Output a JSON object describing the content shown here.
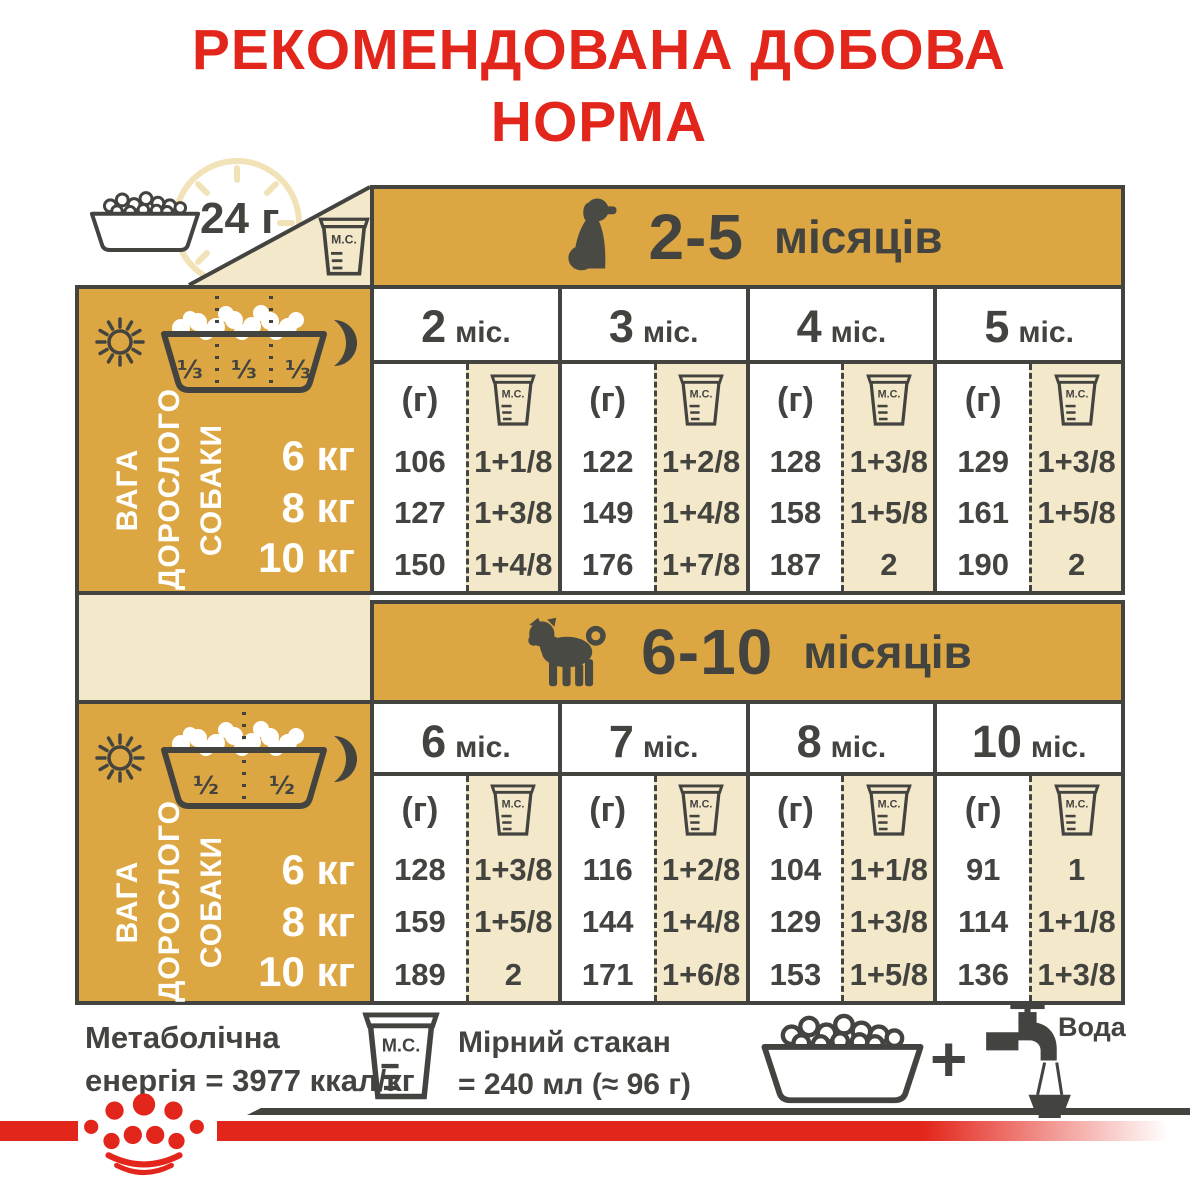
{
  "title": {
    "line1": "РЕКОМЕНДОВАНА ДОБОВА",
    "line2": "НОРМА"
  },
  "legend": {
    "daily": "24 г"
  },
  "cup_label": "М.С.",
  "gram_label": "(г)",
  "side": {
    "label_lines": [
      "ВАГА",
      "ДОРОСЛОГО",
      "СОБАКИ"
    ],
    "weights": [
      "6 кг",
      "8 кг",
      "10 кг"
    ],
    "thirds": [
      "⅓",
      "⅓",
      "⅓"
    ],
    "halves": [
      "½",
      "½"
    ]
  },
  "tables": [
    {
      "age_num": "2-5",
      "age_word": "місяців",
      "months": [
        {
          "n": "2",
          "u": "міс."
        },
        {
          "n": "3",
          "u": "міс."
        },
        {
          "n": "4",
          "u": "міс."
        },
        {
          "n": "5",
          "u": "міс."
        }
      ],
      "rows": [
        {
          "g": [
            "106",
            "122",
            "128",
            "129"
          ],
          "ms": [
            "1+1/8",
            "1+2/8",
            "1+3/8",
            "1+3/8"
          ]
        },
        {
          "g": [
            "127",
            "149",
            "158",
            "161"
          ],
          "ms": [
            "1+3/8",
            "1+4/8",
            "1+5/8",
            "1+5/8"
          ]
        },
        {
          "g": [
            "150",
            "176",
            "187",
            "190"
          ],
          "ms": [
            "1+4/8",
            "1+7/8",
            "2",
            "2"
          ]
        }
      ]
    },
    {
      "age_num": "6-10",
      "age_word": "місяців",
      "months": [
        {
          "n": "6",
          "u": "міс."
        },
        {
          "n": "7",
          "u": "міс."
        },
        {
          "n": "8",
          "u": "міс."
        },
        {
          "n": "10",
          "u": "міс."
        }
      ],
      "rows": [
        {
          "g": [
            "128",
            "116",
            "104",
            "91"
          ],
          "ms": [
            "1+3/8",
            "1+2/8",
            "1+1/8",
            "1"
          ]
        },
        {
          "g": [
            "159",
            "144",
            "129",
            "114"
          ],
          "ms": [
            "1+5/8",
            "1+4/8",
            "1+3/8",
            "1+1/8"
          ]
        },
        {
          "g": [
            "189",
            "171",
            "153",
            "136"
          ],
          "ms": [
            "2",
            "1+6/8",
            "1+5/8",
            "1+3/8"
          ]
        }
      ]
    }
  ],
  "footer": {
    "energy_line1": "Метаболічна",
    "energy_line2": "енергія = 3977 ккал/кг",
    "cup_line1": "Мірний стакан",
    "cup_line2": "= 240 мл (≈ 96 г)",
    "plus": "+",
    "water": "Вода"
  },
  "colors": {
    "red": "#E3261B",
    "gold": "#DCA742",
    "cream": "#F3E8C9",
    "dark": "#434340"
  }
}
